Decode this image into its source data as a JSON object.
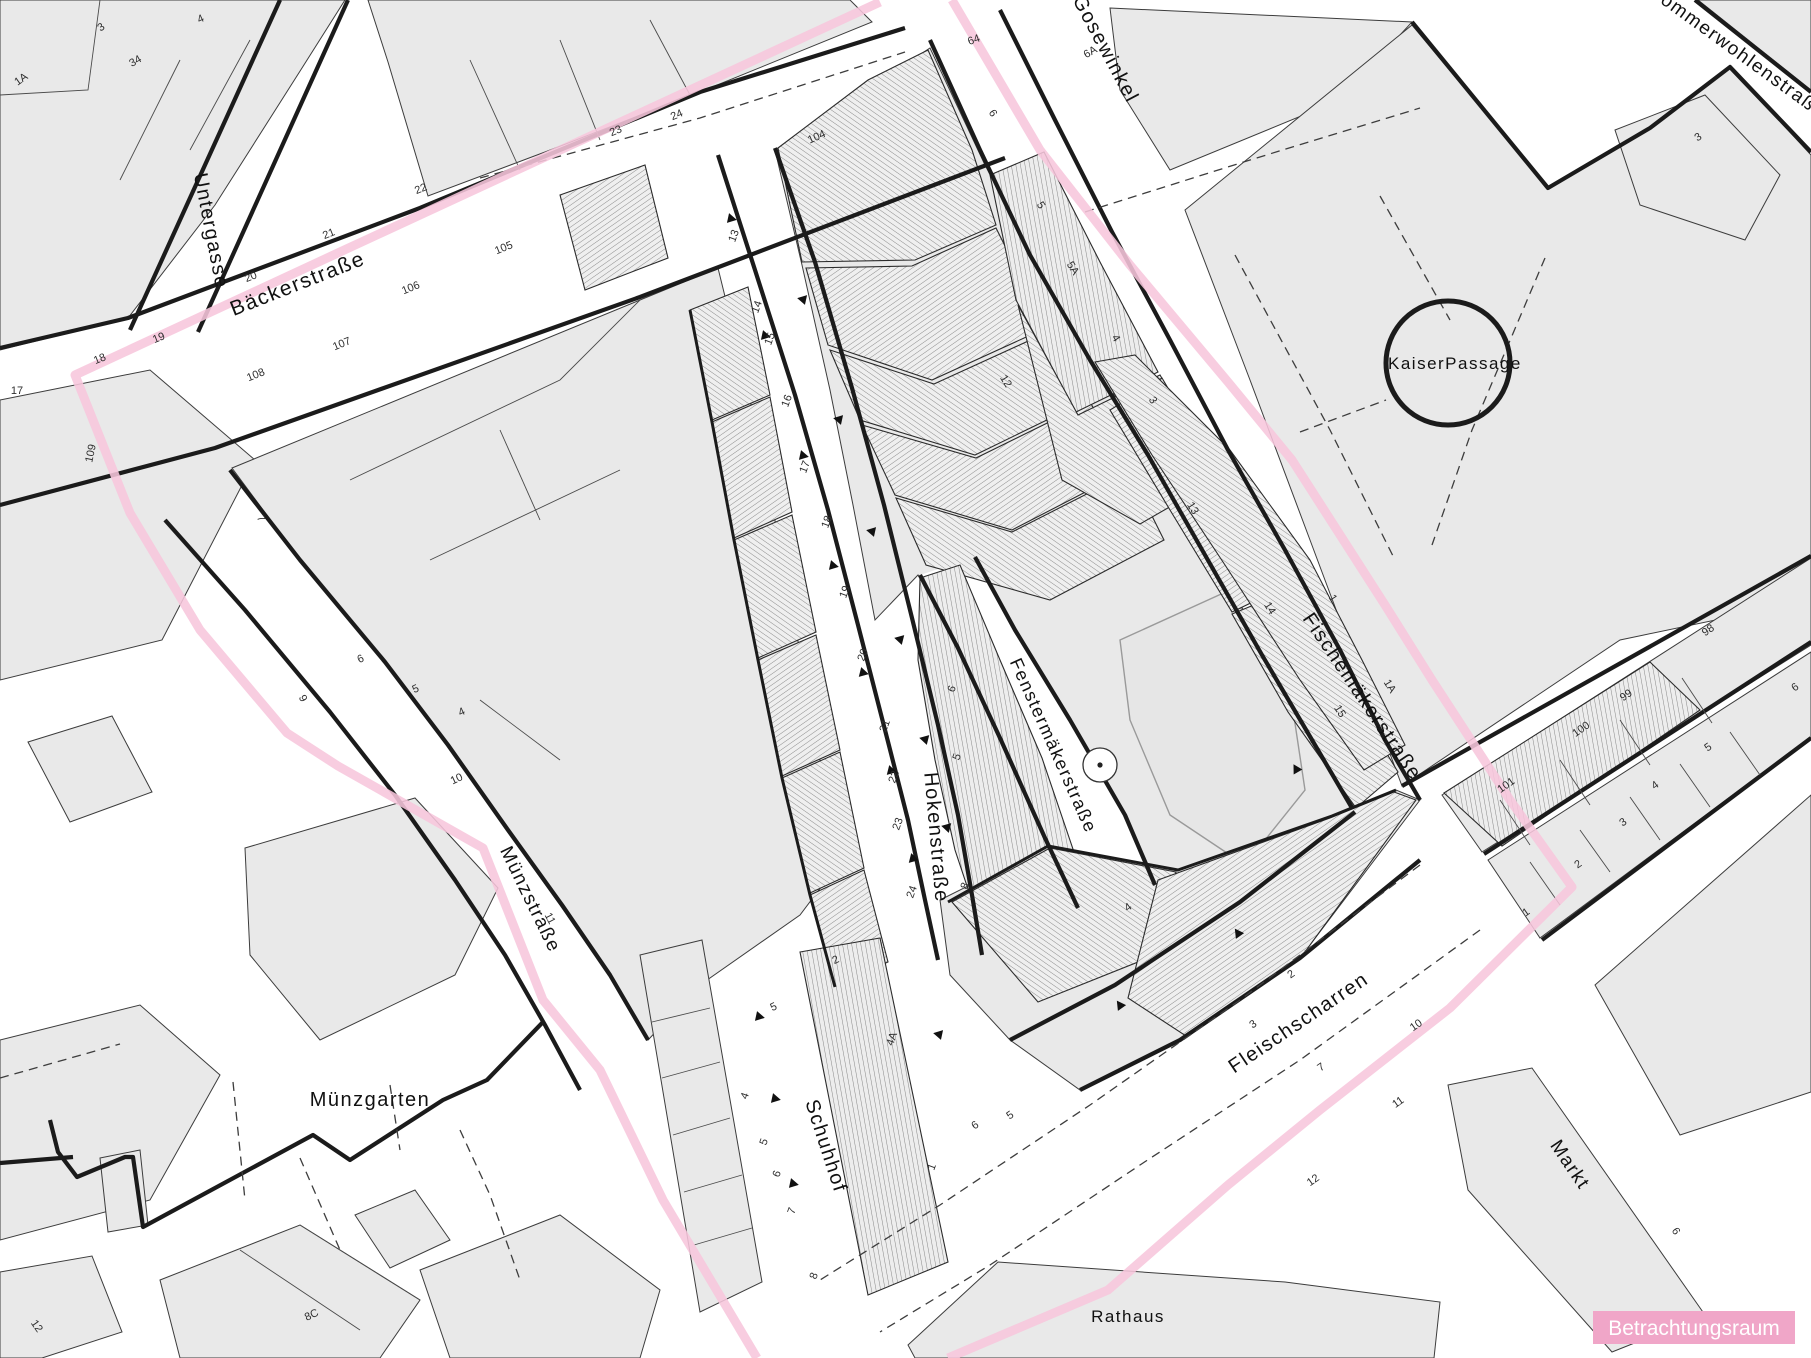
{
  "map": {
    "title": "Betrachtungsraum Stadtkarte",
    "legend": {
      "label": "Betrachtungsraum",
      "bg": "#f0a6c8",
      "fg": "#ffffff"
    },
    "colors": {
      "boundary_pink": "#f7c6dc",
      "block_fill": "#e9e9e9",
      "hatch_line": "#8c8c8c",
      "outline_thick": "#1b1b1b",
      "outline_thin": "#4a4a4a"
    },
    "boundary": {
      "name": "Betrachtungsraum",
      "stroke_width": 9,
      "west": [
        [
          880,
          2
        ],
        [
          340,
          252
        ],
        [
          75,
          375
        ],
        [
          130,
          513
        ],
        [
          200,
          630
        ],
        [
          287,
          733
        ],
        [
          338,
          766
        ],
        [
          460,
          835
        ],
        [
          483,
          848
        ],
        [
          543,
          1000
        ],
        [
          600,
          1070
        ],
        [
          663,
          1200
        ],
        [
          757,
          1358
        ]
      ],
      "east": [
        [
          952,
          0
        ],
        [
          1040,
          150
        ],
        [
          1130,
          265
        ],
        [
          1228,
          382
        ],
        [
          1292,
          460
        ],
        [
          1385,
          605
        ],
        [
          1432,
          680
        ],
        [
          1510,
          800
        ],
        [
          1572,
          887
        ],
        [
          1450,
          1008
        ],
        [
          1320,
          1110
        ],
        [
          1228,
          1185
        ],
        [
          1108,
          1290
        ],
        [
          948,
          1358
        ]
      ]
    },
    "streets": [
      {
        "id": "untergasse",
        "label": "Untergasse",
        "x": 205,
        "y": 232,
        "rot": 79,
        "size": 20
      },
      {
        "id": "baeckerstrasse",
        "label": "Bäckerstraße",
        "x": 300,
        "y": 290,
        "rot": -21.5,
        "size": 21
      },
      {
        "id": "gosewinkel",
        "label": "Gosewinkel",
        "x": 1100,
        "y": 52,
        "rot": 62,
        "size": 20
      },
      {
        "id": "sommerwohlenstrasse",
        "label": "Sommerwohlenstraße",
        "x": 1648,
        "y": -6,
        "rot": 36,
        "size": 19,
        "anchor": "start"
      },
      {
        "id": "kaiserpassage",
        "label": "KaiserPassage",
        "x": 1388,
        "y": 369,
        "rot": 0,
        "size": 17,
        "anchor": "start",
        "spacing": 0
      },
      {
        "id": "fischemaekerstrasse",
        "label": "Fischemäkerstraße",
        "x": 1357,
        "y": 700,
        "rot": 56,
        "size": 20
      },
      {
        "id": "fenstermaekerstrasse",
        "label": "Fenstermäkerstraße",
        "x": 1048,
        "y": 748,
        "rot": 66,
        "size": 18
      },
      {
        "id": "hokenstrasse",
        "label": "Hokenstraße",
        "x": 930,
        "y": 838,
        "rot": 85,
        "size": 20
      },
      {
        "id": "muenzstrasse",
        "label": "Münzstraße",
        "x": 525,
        "y": 902,
        "rot": 64,
        "size": 19
      },
      {
        "id": "muenzgarten",
        "label": "Münzgarten",
        "x": 370,
        "y": 1106,
        "rot": 0,
        "size": 20,
        "spacing": 0.5
      },
      {
        "id": "schuhhof",
        "label": "Schuhhof",
        "x": 820,
        "y": 1148,
        "rot": 72,
        "size": 20
      },
      {
        "id": "fleischscharren",
        "label": "Fleischscharren",
        "x": 1302,
        "y": 1028,
        "rot": -34,
        "size": 20
      },
      {
        "id": "markt",
        "label": "Markt",
        "x": 1565,
        "y": 1168,
        "rot": 56,
        "size": 19
      },
      {
        "id": "rathaus",
        "label": "Rathaus",
        "x": 1128,
        "y": 1322,
        "rot": 0,
        "size": 17,
        "spacing": 0
      }
    ],
    "house_numbers": [
      {
        "t": "1A",
        "x": 23,
        "y": 82,
        "r": -35
      },
      {
        "t": "3",
        "x": 103,
        "y": 30,
        "r": -35
      },
      {
        "t": "34",
        "x": 137,
        "y": 64,
        "r": -30
      },
      {
        "t": "4",
        "x": 202,
        "y": 22,
        "r": -25
      },
      {
        "t": "24",
        "x": 678,
        "y": 118,
        "r": -23
      },
      {
        "t": "23",
        "x": 617,
        "y": 134,
        "r": -23
      },
      {
        "t": "22",
        "x": 422,
        "y": 192,
        "r": -22
      },
      {
        "t": "21",
        "x": 330,
        "y": 237,
        "r": -22
      },
      {
        "t": "20",
        "x": 252,
        "y": 280,
        "r": -22
      },
      {
        "t": "19",
        "x": 160,
        "y": 341,
        "r": -22
      },
      {
        "t": "18",
        "x": 101,
        "y": 362,
        "r": -22
      },
      {
        "t": "17",
        "x": 17,
        "y": 394,
        "r": 0
      },
      {
        "t": "105",
        "x": 505,
        "y": 251,
        "r": -22
      },
      {
        "t": "106",
        "x": 412,
        "y": 291,
        "r": -22
      },
      {
        "t": "107",
        "x": 343,
        "y": 347,
        "r": -22
      },
      {
        "t": "108",
        "x": 257,
        "y": 378,
        "r": -22
      },
      {
        "t": "109",
        "x": 94,
        "y": 454,
        "r": -78
      },
      {
        "t": "7",
        "x": 258,
        "y": 520,
        "r": 62
      },
      {
        "t": "9",
        "x": 300,
        "y": 700,
        "r": 62
      },
      {
        "t": "6",
        "x": 362,
        "y": 662,
        "r": -25
      },
      {
        "t": "5",
        "x": 417,
        "y": 692,
        "r": -25
      },
      {
        "t": "4",
        "x": 463,
        "y": 715,
        "r": -25
      },
      {
        "t": "10",
        "x": 458,
        "y": 782,
        "r": -25
      },
      {
        "t": "11",
        "x": 547,
        "y": 920,
        "r": 62
      },
      {
        "t": "13",
        "x": 737,
        "y": 237,
        "r": -70
      },
      {
        "t": "14",
        "x": 760,
        "y": 308,
        "r": -70
      },
      {
        "t": "15",
        "x": 773,
        "y": 340,
        "r": -70
      },
      {
        "t": "16",
        "x": 790,
        "y": 402,
        "r": -70
      },
      {
        "t": "17",
        "x": 808,
        "y": 468,
        "r": -70
      },
      {
        "t": "18",
        "x": 830,
        "y": 523,
        "r": -70
      },
      {
        "t": "19",
        "x": 848,
        "y": 593,
        "r": -70
      },
      {
        "t": "20",
        "x": 866,
        "y": 656,
        "r": -70
      },
      {
        "t": "21",
        "x": 888,
        "y": 727,
        "r": -70
      },
      {
        "t": "22",
        "x": 897,
        "y": 778,
        "r": -70
      },
      {
        "t": "23",
        "x": 901,
        "y": 825,
        "r": -70
      },
      {
        "t": "24",
        "x": 915,
        "y": 893,
        "r": -70
      },
      {
        "t": "104",
        "x": 818,
        "y": 140,
        "r": -24
      },
      {
        "t": "6",
        "x": 955,
        "y": 690,
        "r": -70
      },
      {
        "t": "5",
        "x": 960,
        "y": 758,
        "r": -70
      },
      {
        "t": "8",
        "x": 968,
        "y": 887,
        "r": -70
      },
      {
        "t": "64",
        "x": 975,
        "y": 43,
        "r": -20
      },
      {
        "t": "6A",
        "x": 1092,
        "y": 55,
        "r": -30
      },
      {
        "t": "6",
        "x": 990,
        "y": 115,
        "r": 58
      },
      {
        "t": "5",
        "x": 1038,
        "y": 207,
        "r": 58
      },
      {
        "t": "5A",
        "x": 1070,
        "y": 270,
        "r": 58
      },
      {
        "t": "4",
        "x": 1113,
        "y": 340,
        "r": 58
      },
      {
        "t": "3",
        "x": 1150,
        "y": 402,
        "r": 58
      },
      {
        "t": "12",
        "x": 1003,
        "y": 383,
        "r": 58
      },
      {
        "t": "13",
        "x": 1190,
        "y": 510,
        "r": 58
      },
      {
        "t": "14",
        "x": 1267,
        "y": 610,
        "r": 58
      },
      {
        "t": "15",
        "x": 1337,
        "y": 713,
        "r": 58
      },
      {
        "t": "1",
        "x": 1330,
        "y": 600,
        "r": 58
      },
      {
        "t": "1A",
        "x": 1387,
        "y": 688,
        "r": 58
      },
      {
        "t": "3",
        "x": 1700,
        "y": 140,
        "r": -33
      },
      {
        "t": "98",
        "x": 1710,
        "y": 633,
        "r": -35
      },
      {
        "t": "99",
        "x": 1628,
        "y": 698,
        "r": -35
      },
      {
        "t": "100",
        "x": 1583,
        "y": 732,
        "r": -35
      },
      {
        "t": "101",
        "x": 1508,
        "y": 788,
        "r": -35
      },
      {
        "t": "6",
        "x": 1797,
        "y": 690,
        "r": -35
      },
      {
        "t": "5",
        "x": 1710,
        "y": 750,
        "r": -35
      },
      {
        "t": "4",
        "x": 1657,
        "y": 788,
        "r": -35
      },
      {
        "t": "3",
        "x": 1625,
        "y": 825,
        "r": -35
      },
      {
        "t": "2",
        "x": 1580,
        "y": 867,
        "r": -35
      },
      {
        "t": "1",
        "x": 1528,
        "y": 915,
        "r": -35
      },
      {
        "t": "2",
        "x": 1293,
        "y": 977,
        "r": -35
      },
      {
        "t": "3",
        "x": 1255,
        "y": 1027,
        "r": -35
      },
      {
        "t": "4",
        "x": 1130,
        "y": 910,
        "r": -35
      },
      {
        "t": "5",
        "x": 1012,
        "y": 1118,
        "r": -35
      },
      {
        "t": "6",
        "x": 977,
        "y": 1128,
        "r": -35
      },
      {
        "t": "7",
        "x": 1323,
        "y": 1070,
        "r": -35
      },
      {
        "t": "10",
        "x": 1418,
        "y": 1028,
        "r": -35
      },
      {
        "t": "11",
        "x": 1400,
        "y": 1105,
        "r": -35
      },
      {
        "t": "12",
        "x": 1315,
        "y": 1183,
        "r": -35
      },
      {
        "t": "6",
        "x": 1673,
        "y": 1233,
        "r": 58
      },
      {
        "t": "4",
        "x": 748,
        "y": 1097,
        "r": -70
      },
      {
        "t": "5",
        "x": 767,
        "y": 1143,
        "r": -70
      },
      {
        "t": "6",
        "x": 780,
        "y": 1175,
        "r": -70
      },
      {
        "t": "7",
        "x": 795,
        "y": 1212,
        "r": -70
      },
      {
        "t": "8",
        "x": 817,
        "y": 1277,
        "r": -70
      },
      {
        "t": "4A",
        "x": 895,
        "y": 1040,
        "r": -70
      },
      {
        "t": "2",
        "x": 837,
        "y": 963,
        "r": -25
      },
      {
        "t": "5",
        "x": 775,
        "y": 1010,
        "r": -25
      },
      {
        "t": "1",
        "x": 935,
        "y": 1168,
        "r": -70
      },
      {
        "t": "8C",
        "x": 313,
        "y": 1318,
        "r": -25
      },
      {
        "t": "12",
        "x": 34,
        "y": 1328,
        "r": 55
      }
    ],
    "arrows": [
      {
        "x": 728,
        "y": 218,
        "r": 12
      },
      {
        "x": 762,
        "y": 335,
        "r": 12
      },
      {
        "x": 800,
        "y": 455,
        "r": 12
      },
      {
        "x": 830,
        "y": 565,
        "r": 12
      },
      {
        "x": 860,
        "y": 672,
        "r": 14
      },
      {
        "x": 888,
        "y": 770,
        "r": 14
      },
      {
        "x": 910,
        "y": 858,
        "r": 14
      },
      {
        "x": 806,
        "y": 300,
        "r": 192
      },
      {
        "x": 842,
        "y": 420,
        "r": 192
      },
      {
        "x": 875,
        "y": 532,
        "r": 192
      },
      {
        "x": 903,
        "y": 640,
        "r": 194
      },
      {
        "x": 928,
        "y": 740,
        "r": 194
      },
      {
        "x": 950,
        "y": 828,
        "r": 194
      },
      {
        "x": 756,
        "y": 1016,
        "r": 12
      },
      {
        "x": 772,
        "y": 1098,
        "r": 12
      },
      {
        "x": 790,
        "y": 1183,
        "r": 12
      },
      {
        "x": 942,
        "y": 1035,
        "r": 192
      },
      {
        "x": 1240,
        "y": 936,
        "r": 235
      },
      {
        "x": 1122,
        "y": 1008,
        "r": 235
      },
      {
        "x": 1298,
        "y": 772,
        "r": 240
      }
    ],
    "landmarks": {
      "kaiserpassage_circle": {
        "cx": 1448,
        "cy": 363,
        "r": 62
      },
      "tree_circle": {
        "cx": 1100,
        "cy": 765,
        "r": 17
      }
    }
  }
}
